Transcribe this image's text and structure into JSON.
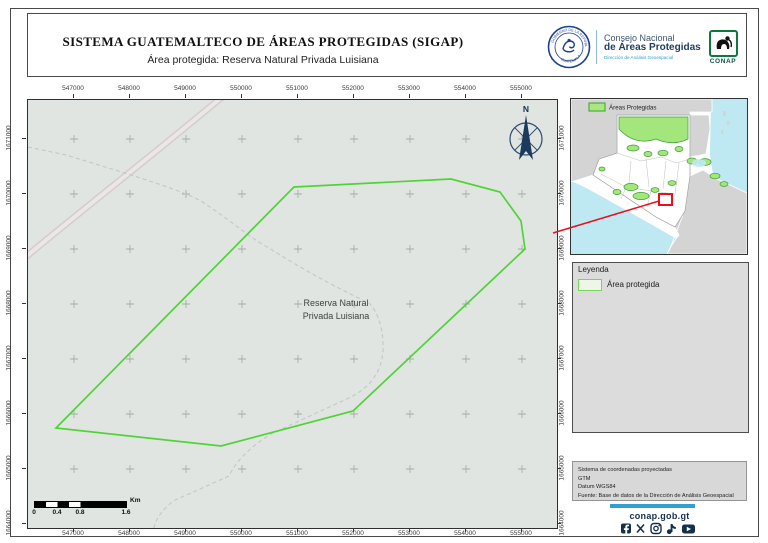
{
  "header": {
    "title": "SISTEMA GUATEMALTECO DE ÁREAS PROTEGIDAS (SIGAP)",
    "subtitle": "Área protegida: Reserva Natural Privada Luisiana",
    "seal_text_top": "GOBIERNO DE LA REPÚBLICA",
    "seal_text_bottom": "GUATEMALA",
    "consejo_line1": "Consejo Nacional",
    "consejo_line2": "de Áreas Protegidas",
    "consejo_line3": "Dirección de Análisis Geoespacial",
    "conap_label": "CONAP"
  },
  "map": {
    "label_line1": "Reserva Natural",
    "label_line2": "Privada Luisiana",
    "north_label": "N",
    "x_ticks": [
      "547000",
      "548000",
      "549000",
      "550000",
      "551000",
      "552000",
      "553000",
      "554000",
      "555000"
    ],
    "y_ticks": [
      "1671000",
      "1670000",
      "1669000",
      "1668000",
      "1667000",
      "1666000",
      "1665000",
      "1664000"
    ],
    "scalebar": {
      "labels": [
        "0",
        "0.4",
        "0.8",
        "1.6"
      ],
      "unit": "Km"
    },
    "geometry": {
      "polygon_points": "266,87 423,79 472,92 493,121 497,149 325,311 193,346 28,328",
      "road_d": "M-6,160 C60,105 125,55 200,-8",
      "trail_d": "M0,47 L38,55 C100,74 148,88 173,101 C205,122 222,138 241,148 C285,176 320,193 341,203 C350,212 356,230 355,251 C353,277 337,290 321,298 L245,333 C226,344 209,359 201,376 L145,401 C136,409 128,417 126,428",
      "leader_points": "553,233 659,201"
    }
  },
  "inset": {
    "legend_label": "Áreas Protegidas"
  },
  "legend": {
    "title": "Leyenda",
    "item_label": "Área protegida"
  },
  "credits": {
    "lines": [
      "Sistema de coordenadas proyectadas",
      "GTM",
      "Datum WGS84",
      "Fuente: Base de datos de la Dirección de Análisis Geoespacial"
    ]
  },
  "footer": {
    "website": "conap.gob.gt",
    "social_icons": [
      "facebook",
      "x",
      "instagram",
      "tiktok",
      "youtube"
    ]
  },
  "colors": {
    "map_background": "#e1e5e1",
    "protected_area_green": "#50d338",
    "inset_protected_fill": "#a3e77c",
    "inset_protected_stroke": "#3f9c35",
    "water_cyan": "#bfe9f2",
    "neighbor_gray": "#d4d4d4",
    "locator_red": "#e8101f",
    "accent_blue": "#2f9fd6",
    "navy": "#1c3a5e"
  }
}
